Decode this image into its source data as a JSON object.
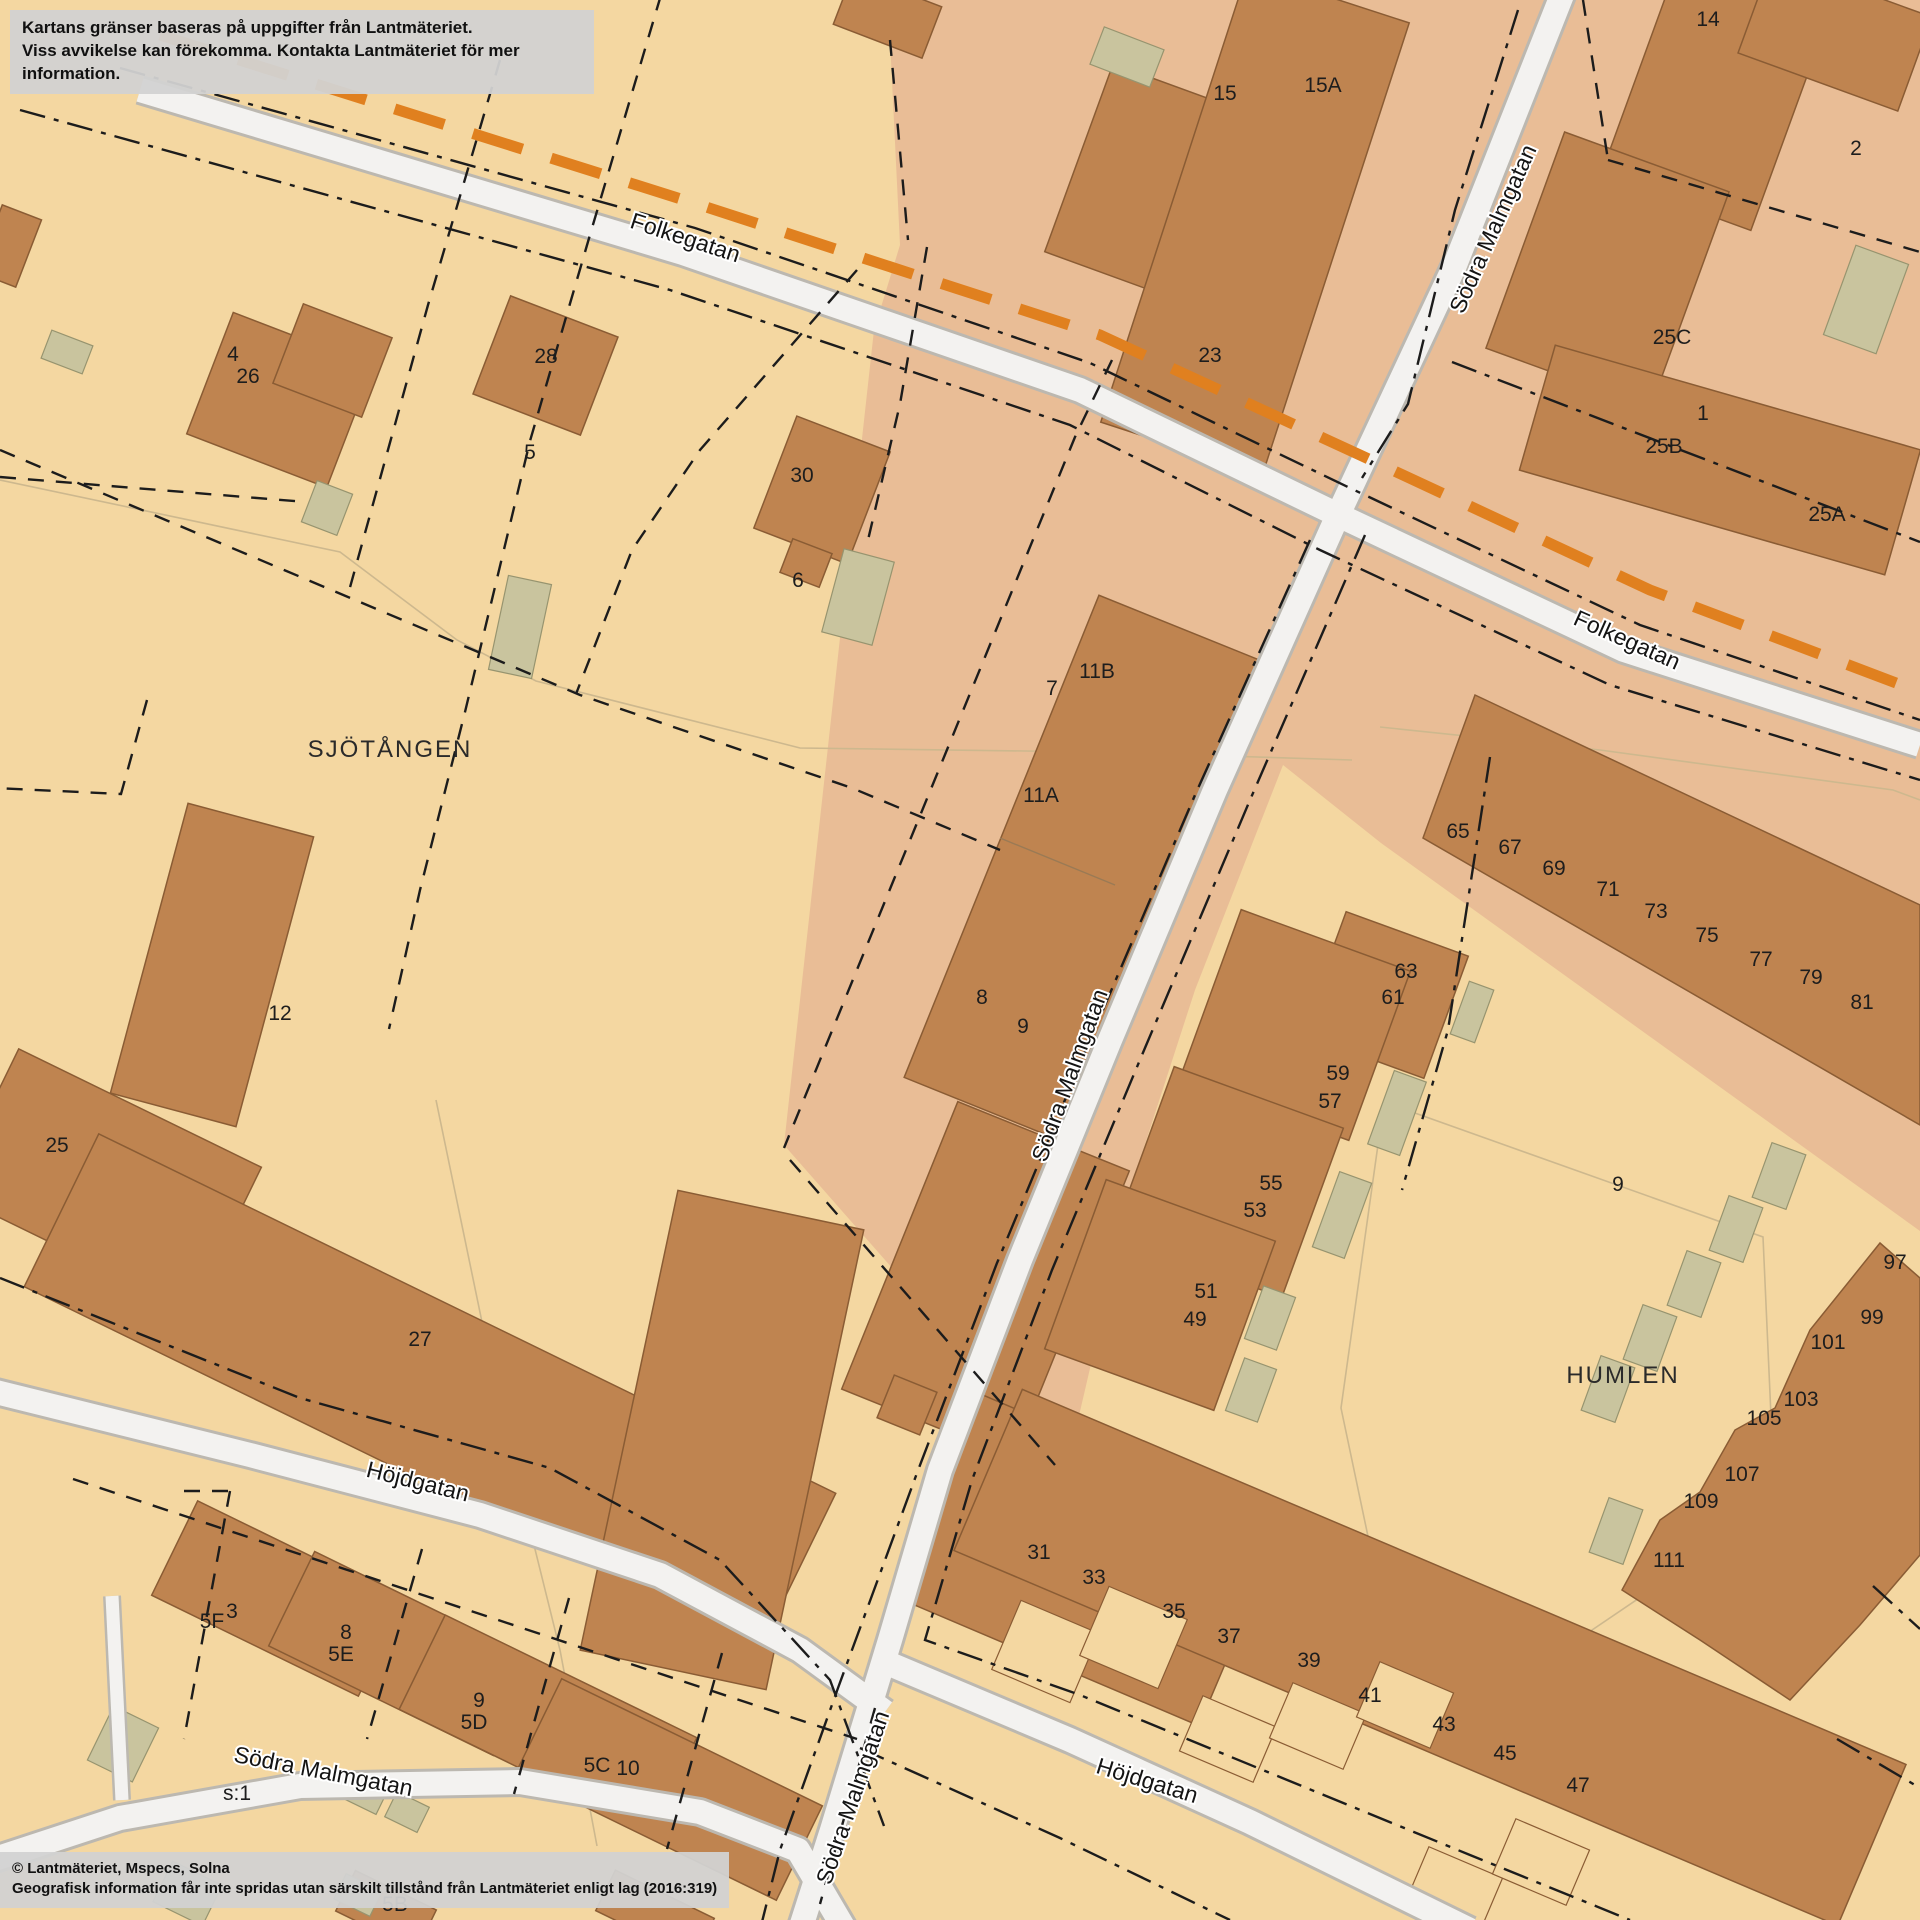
{
  "disclaimer": {
    "line1": "Kartans gränser baseras på uppgifter från Lantmäteriet.",
    "line2": "Viss avvikelse kan förekomma. Kontakta Lantmäteriet för mer information."
  },
  "copyright": {
    "line1": "© Lantmäteriet, Mspecs, Solna",
    "line2": "Geografisk information får inte spridas utan särskilt tillstånd från Lantmäteriet enligt lag (2016:319)"
  },
  "labels": {
    "area": [
      "SJÖTÅNGEN",
      "HUMLEN"
    ],
    "streets": [
      "Folkegatan",
      "Folkegatan",
      "Södra Malmgatan",
      "Södra Malmgatan",
      "Södra Malmgatan",
      "Södra Malmgatan",
      "Höjdgatan",
      "Höjdgatan"
    ],
    "house_numbers": [
      "4",
      "26",
      "28",
      "5",
      "30",
      "6",
      "15",
      "15A",
      "23",
      "14",
      "2",
      "25C",
      "1",
      "25B",
      "25A",
      "7",
      "11B",
      "11A",
      "8",
      "9",
      "12",
      "25",
      "27",
      "65",
      "67",
      "69",
      "71",
      "73",
      "75",
      "77",
      "79",
      "81",
      "63",
      "61",
      "59",
      "57",
      "55",
      "53",
      "51",
      "49",
      "9",
      "97",
      "99",
      "101",
      "103",
      "105",
      "107",
      "109",
      "111",
      "31",
      "33",
      "35",
      "37",
      "39",
      "41",
      "43",
      "45",
      "47",
      "5F",
      "3",
      "8",
      "5E",
      "9",
      "5D",
      "5C",
      "10",
      "s:1",
      "5B"
    ]
  },
  "colors": {
    "background_beige": "#f4d7a1",
    "district_highlight": "#e9bd96",
    "building_brown": "#bf8450",
    "building_stroke": "#8a5c34",
    "outbuilding_khaki": "#c9c49e",
    "outbuilding_stroke": "#97946f",
    "road_fill": "#f3f2f0",
    "road_casing": "#bcb8b0",
    "route_orange": "#e0801f",
    "boundary_black": "#1c1c1c",
    "faint_line": "#cdb88e",
    "info_box_gray": "#d2d2d2"
  }
}
